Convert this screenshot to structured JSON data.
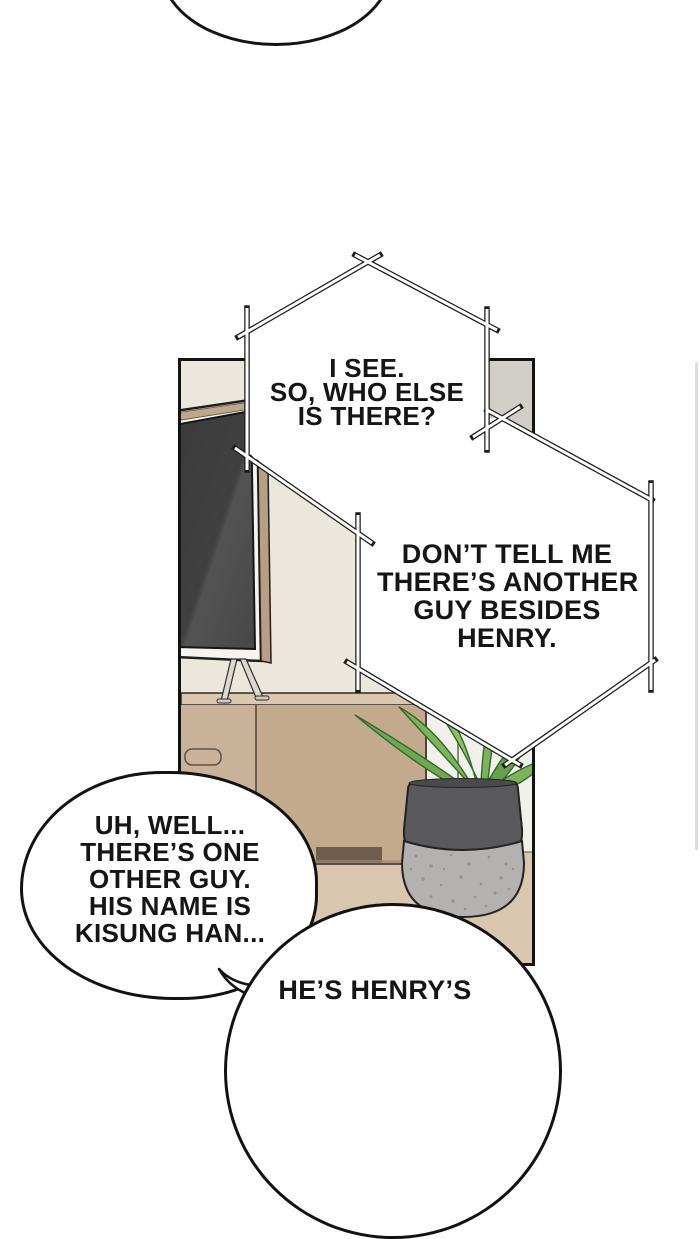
{
  "comic": {
    "bubbles": {
      "hex1": {
        "lines": [
          "I SEE.",
          "SO, WHO ELSE",
          "IS THERE?"
        ]
      },
      "hex2": {
        "lines": [
          "DON’T TELL ME",
          "THERE’S ANOTHER",
          "GUY BESIDES",
          "HENRY."
        ]
      },
      "oval_left": {
        "lines": [
          "UH, WELL...",
          "THERE’S ONE",
          "OTHER GUY.",
          "HIS NAME IS",
          "KISUNG HAN..."
        ]
      },
      "bottom_partial": {
        "lines": [
          "HE’S HENRY’S"
        ]
      }
    },
    "panel_scene": {
      "objects": [
        "television",
        "tv-stand-legs",
        "media-cabinet",
        "potted-plant",
        "doorway"
      ]
    },
    "colors": {
      "page_background": "#ffffff",
      "ink": "#141414",
      "wall_cream": "#ece7dd",
      "wall_gray": "#d1cec8",
      "doorway_white": "#f2f0ea",
      "cabinet_top": "#d9c5ad",
      "cabinet_front": "#c3aa8f",
      "cabinet_left": "#cab29a",
      "drawer_slot": "#6f5e4e",
      "floor_tan": "#d9c6ae",
      "tv_screen": "#404040",
      "tv_frame": "#f7f4ef",
      "tv_wood_edge": "#b89e82",
      "pot_dark": "#59595b",
      "pot_stone": "#b4b2b0",
      "leaf_green": "#7cb45b",
      "leaf_dark_green": "#66a14b"
    }
  }
}
